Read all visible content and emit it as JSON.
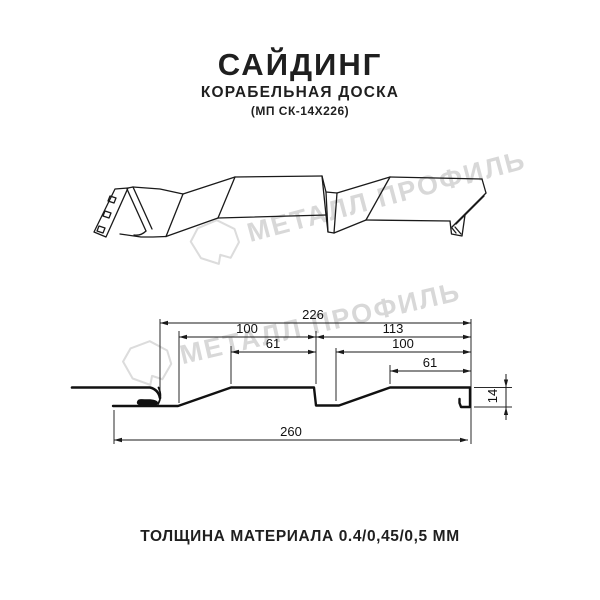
{
  "header": {
    "title": "САЙДИНГ",
    "subtitle": "КОРАБЕЛЬНАЯ ДОСКА",
    "model": "(МП СК-14Х226)"
  },
  "watermark": {
    "text": "МЕТАЛЛ ПРОФИЛЬ",
    "color": "#d8d8d8",
    "logo": "metall-profil-stone-icon"
  },
  "cross_section": {
    "line_color": "#1a1a1a",
    "dims": {
      "d226": "226",
      "d100_left": "100",
      "d113": "113",
      "d61_left": "61",
      "d100_right": "100",
      "d61_right": "61",
      "d260": "260",
      "d14": "14"
    }
  },
  "footer": {
    "text": "ТОЛЩИНА МАТЕРИАЛА 0.4/0,45/0,5 ММ"
  }
}
